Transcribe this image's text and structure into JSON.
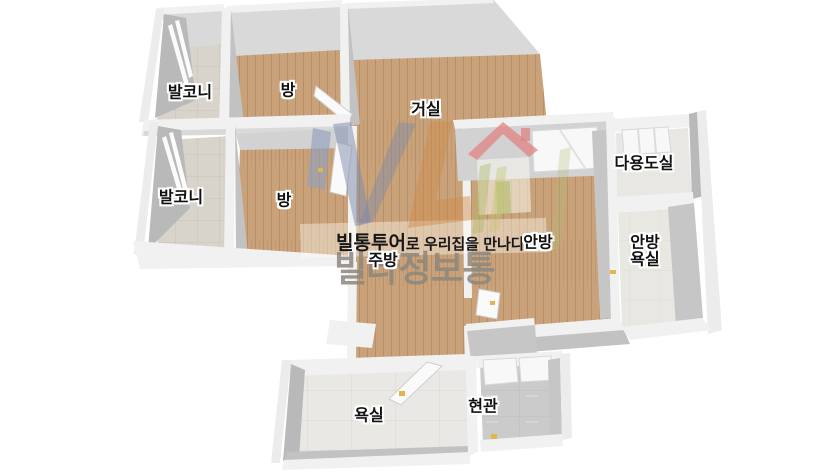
{
  "floorplan": {
    "rooms": [
      {
        "id": "balcony-1",
        "label": "발코니"
      },
      {
        "id": "room-1",
        "label": "방"
      },
      {
        "id": "living-room",
        "label": "거실"
      },
      {
        "id": "balcony-2",
        "label": "발코니"
      },
      {
        "id": "room-2",
        "label": "방"
      },
      {
        "id": "utility-room",
        "label": "다용도실"
      },
      {
        "id": "master-bedroom",
        "label": "안방"
      },
      {
        "id": "master-bathroom",
        "label": "안방\n욕실"
      },
      {
        "id": "kitchen",
        "label": "주방"
      },
      {
        "id": "bathroom",
        "label": "욕실"
      },
      {
        "id": "entrance",
        "label": "현관"
      }
    ],
    "watermark": {
      "slogan_brand": "빌통투어",
      "slogan_rest": "로 우리집을 만나다",
      "brand": "빌라정보통"
    },
    "colors": {
      "wood_floor": "#c9a279",
      "wood_line": "#b68f69",
      "balcony_tile": "#d8d4cb",
      "bath_tile": "#eae8e4",
      "entrance_tile": "#cbcbcb",
      "util_floor": "#e9e7e3",
      "wall_white": "#f1f1f1",
      "wall_gray": "#b9b9b9",
      "wall_slab": "#d9d9d9",
      "label_text": "#111111",
      "brand_watermark": "#8d877e",
      "accent_yellow": "#e3b64a"
    }
  }
}
